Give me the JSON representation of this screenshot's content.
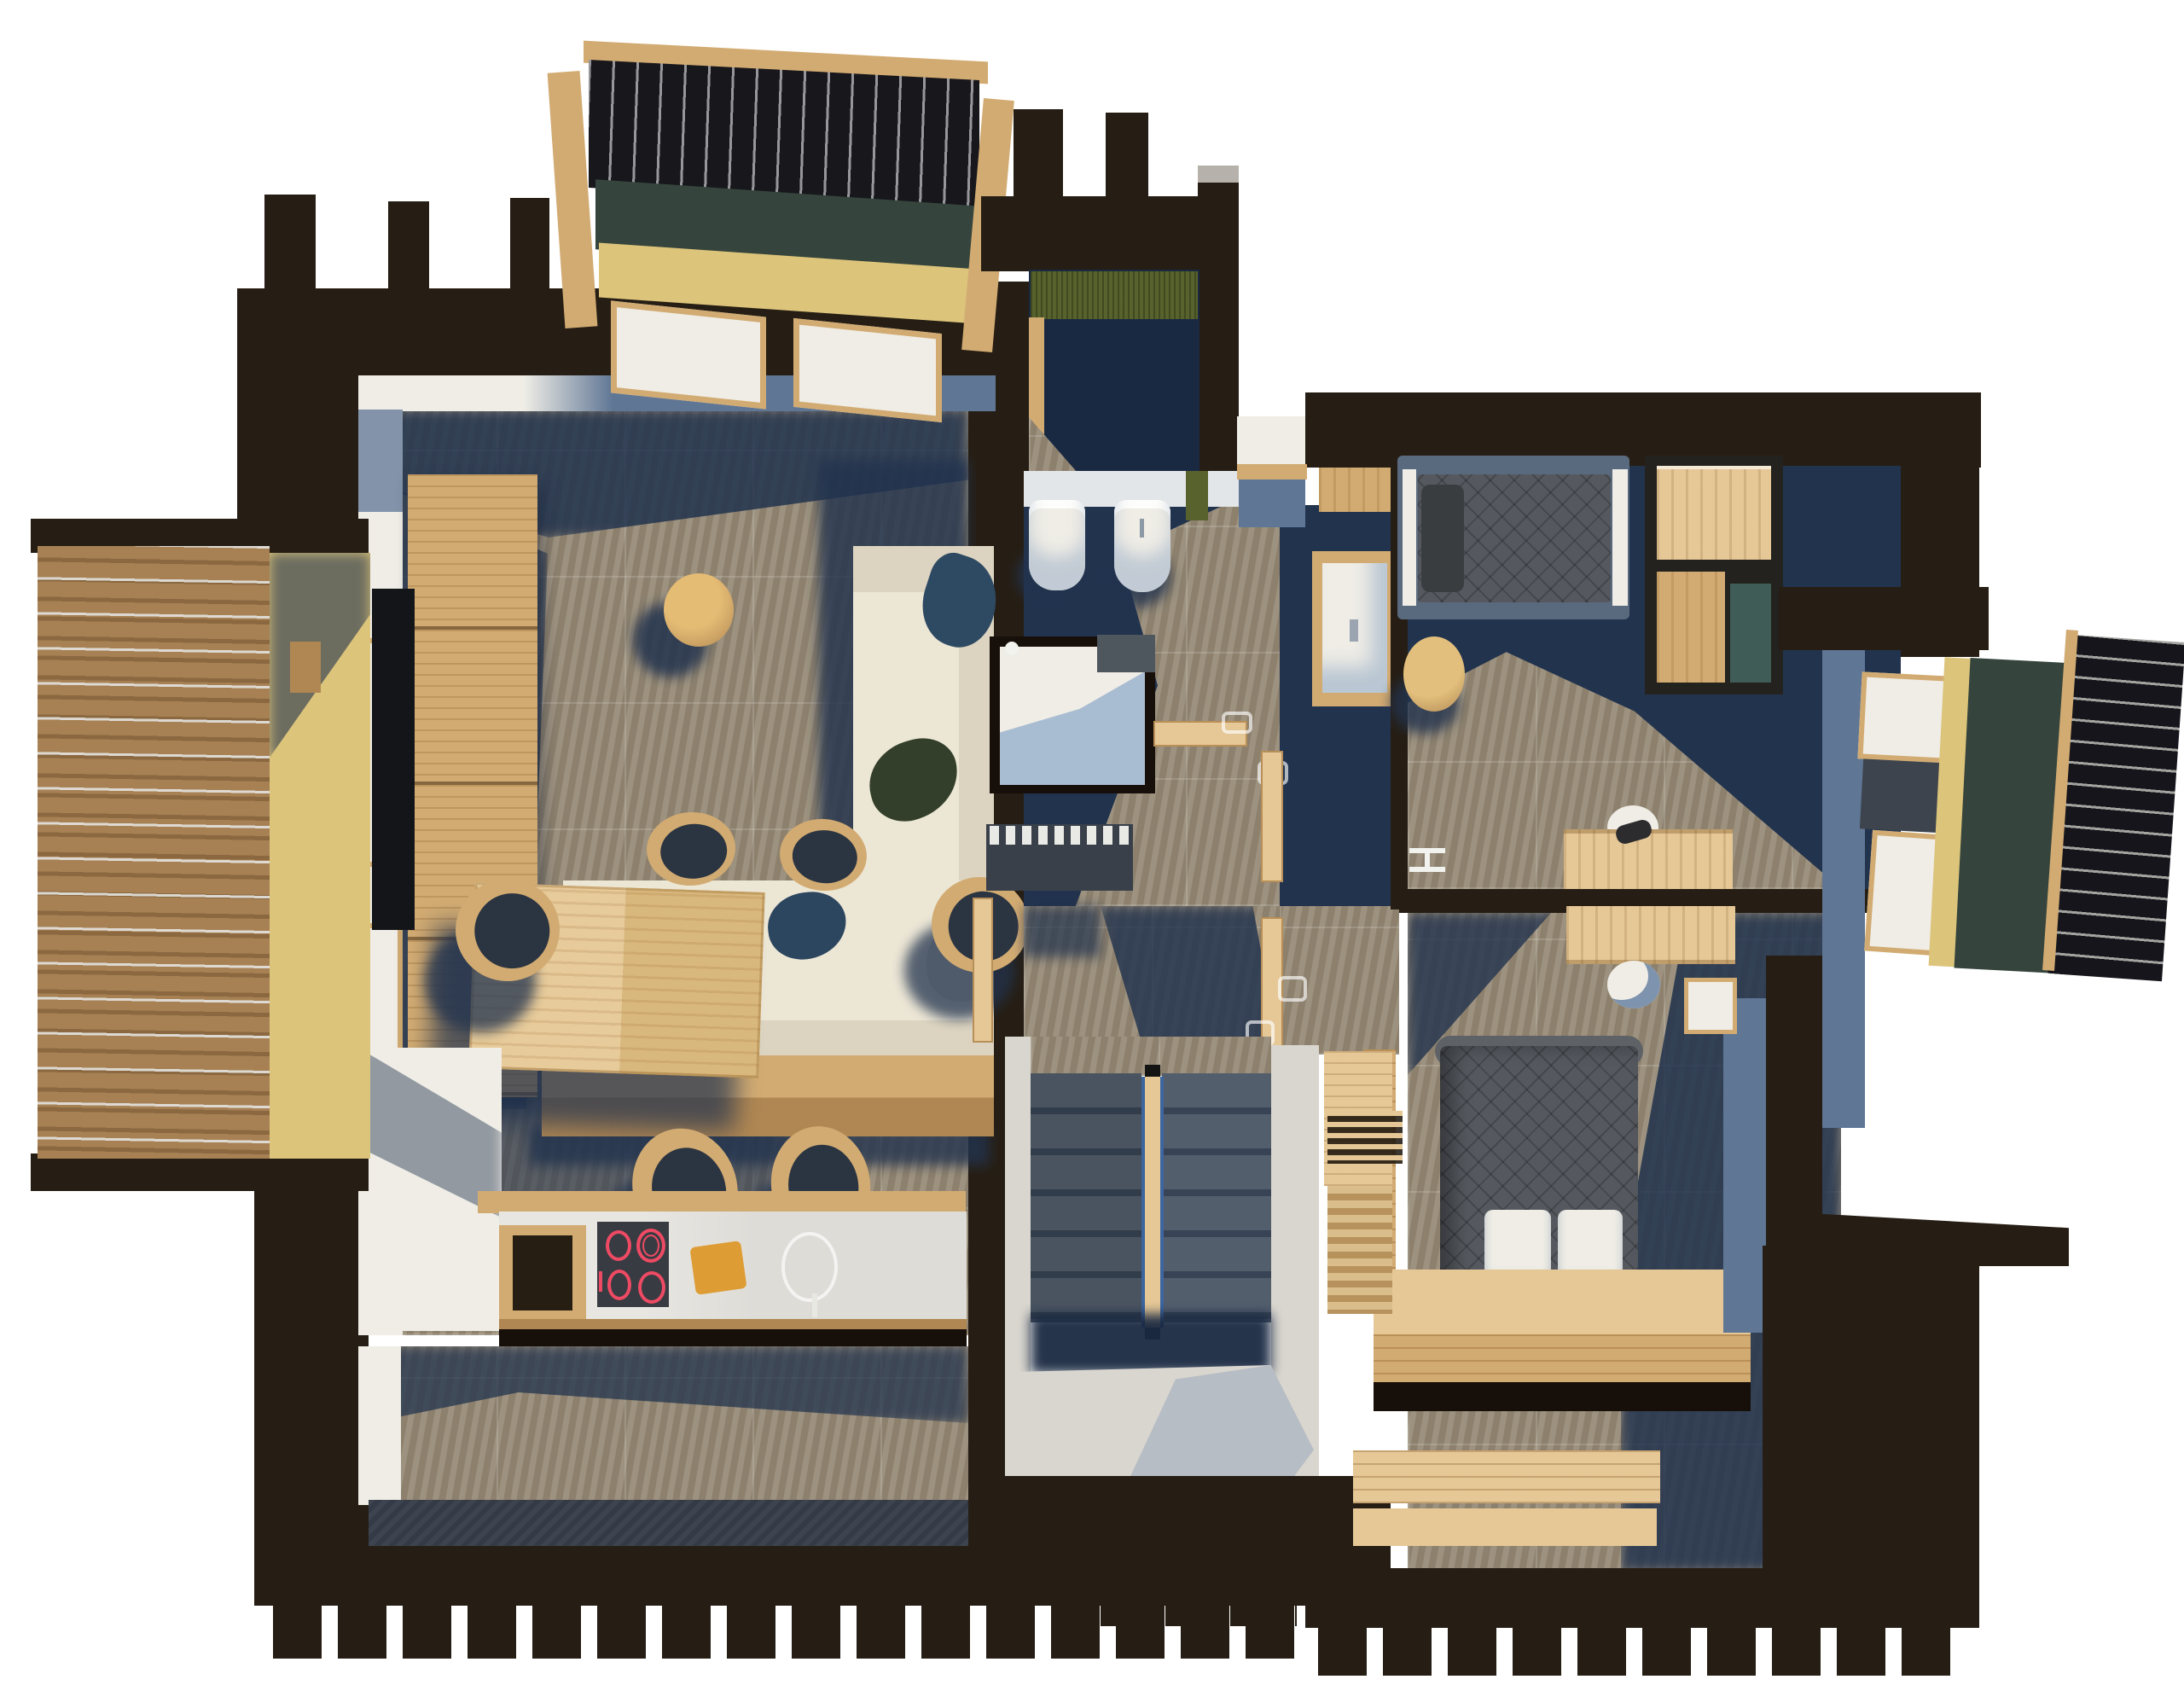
{
  "scene": {
    "type": "3d-floor-plan-render",
    "view": "top-down cutaway of a chalet upper floor, white background, sunlight casting long blue shadows",
    "rooms_note": "no text labels are visible in the render"
  },
  "palette": {
    "bg": "#ffffff",
    "wall": "#261e14",
    "wallDeep": "#170f09",
    "stone": "#978b77",
    "stoneBright": "#a5987f",
    "navy": "#22334e",
    "navyDeep": "#1a2942",
    "woodL": "#e6c897",
    "woodM": "#d2ab72",
    "woodD": "#b08753",
    "cream": "#ece6d5",
    "creamShade": "#dcd4c0",
    "white": "#efede6",
    "blueWall": "#5f7695",
    "grayWall": "#d9d6cf",
    "greenIns": "#35443c",
    "yellowIns": "#dcc47b",
    "greenMat": "#57622c",
    "quilt": "#55595f",
    "quiltDeep": "#3f434a",
    "red": "#ee4a63",
    "board": "#de9c34",
    "deckA": "#a78154",
    "deckB": "#8b683f",
    "teal": "#3f5c57",
    "tread": "#4a5461",
    "treadDark": "#323d4c",
    "radiator": "#39404a",
    "trayShadow": "#a9bdd2"
  },
  "rooms": [
    {
      "id": "living-dining",
      "name": "living room with dining area",
      "furniture": [
        "L-shaped cream sofa with wood base",
        "throw pillows navy green gray",
        "round wood coffee table",
        "wall TV on wood media cabinet",
        "dining table light wood",
        "six chairs wood shell dark seat"
      ]
    },
    {
      "id": "kitchen",
      "name": "kitchen",
      "furniture": [
        "white counter with wood edge",
        "induction hob with red rings",
        "cutting board",
        "round sink with faucet",
        "open wood shelf"
      ]
    },
    {
      "id": "balcony-west",
      "name": "west balcony",
      "furniture": [
        "wood slat decking",
        "metal wire railing",
        "small wood stool"
      ]
    },
    {
      "id": "utility",
      "name": "utility room",
      "furniture": [
        "green textured mat",
        "dark tiled floor"
      ]
    },
    {
      "id": "bathroom",
      "name": "bathroom",
      "furniture": [
        "wall-hung toilet",
        "bidet",
        "walk-in shower with glass",
        "wood vanity with white basin",
        "radiator"
      ]
    },
    {
      "id": "hallway",
      "name": "hallway",
      "furniture": [
        "three wood doors with white handles",
        "section marker"
      ]
    },
    {
      "id": "bedroom-north",
      "name": "bedroom 1",
      "furniture": [
        "single bed dark quilt",
        "wood wardrobe shelves",
        "round wood pouf",
        "desk with white chair"
      ]
    },
    {
      "id": "bedroom-south",
      "name": "master bedroom",
      "furniture": [
        "double bed dark quilt two white pillows",
        "wood platform and foot bench",
        "desk with white chair",
        "wardrobe with hanger rack"
      ]
    },
    {
      "id": "stairwell",
      "name": "staircase",
      "furniture": [
        "double flight dark treads",
        "central wood handrail with glass"
      ]
    },
    {
      "id": "dormer-north",
      "name": "north dormer (section cut)",
      "furniture": [
        "ribbed dark roof",
        "green and yellow insulation layers",
        "double window"
      ]
    },
    {
      "id": "dormer-east",
      "name": "east dormer (section cut)",
      "furniture": [
        "ribbed dark roof",
        "green and yellow insulation layers",
        "two windows"
      ]
    }
  ]
}
